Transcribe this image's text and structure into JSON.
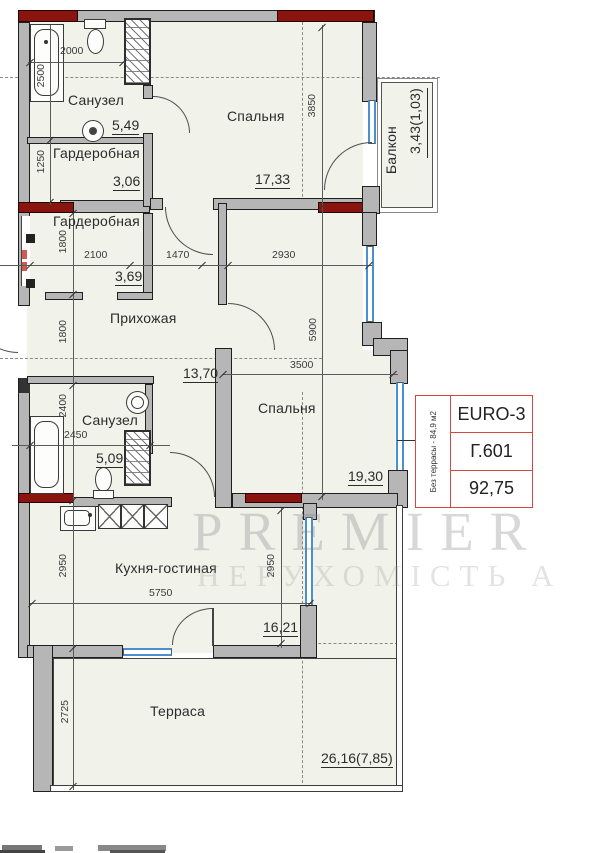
{
  "rooms": {
    "bath1": {
      "name": "Санузел",
      "area": "5,49"
    },
    "wardrobe1": {
      "name": "Гардеробная",
      "area": "3,06"
    },
    "wardrobe2": {
      "name": "Гардеробная",
      "area": "3,69"
    },
    "hallway": {
      "name": "Прихожая",
      "area": "13,70"
    },
    "bedroom1": {
      "name": "Спальня",
      "area": "17,33"
    },
    "balcony": {
      "name": "Балкон",
      "area": "3,43(1,03)"
    },
    "bedroom2": {
      "name": "Спальня",
      "area": "19,30"
    },
    "bath2": {
      "name": "Санузел",
      "area": "5,09"
    },
    "kitchen_living": {
      "name": "Кухня-гостиная",
      "area": "16,21"
    },
    "terrace": {
      "name": "Терраса",
      "area": "26,16(7,85)"
    }
  },
  "dims": {
    "bath1_width": "2000",
    "bath1_height": "2500",
    "wardrobe1_height": "1250",
    "bedroom1_height": "3850",
    "wardrobe2_height": "1800",
    "wardrobe2_width": "2100",
    "hall_top_width": "1470",
    "bedroom1_width": "2930",
    "right_section_height": "5900",
    "hallway_height": "1800",
    "bedroom2_width": "3500",
    "bath2_height": "2400",
    "bath2_width": "2450",
    "kitchen_height_left": "2950",
    "kitchen_width": "5750",
    "kitchen_height_right": "2950",
    "terrace_height": "2725"
  },
  "unit_card": {
    "layout_type": "EURO-3",
    "unit_number": "Г.601",
    "total_area": "92,75",
    "note": "Без террасы - 84,9 м2"
  },
  "watermark": {
    "line1": "PREMIER",
    "line2": "НЕРУХОМІСТЬ А"
  },
  "colors": {
    "load_bearing_red": "#8a150e",
    "card_red": "#d6473f",
    "window_blue": "#4a8fd0",
    "wall_gray": "#b6b6b6",
    "floor": "#f1f3eb"
  }
}
